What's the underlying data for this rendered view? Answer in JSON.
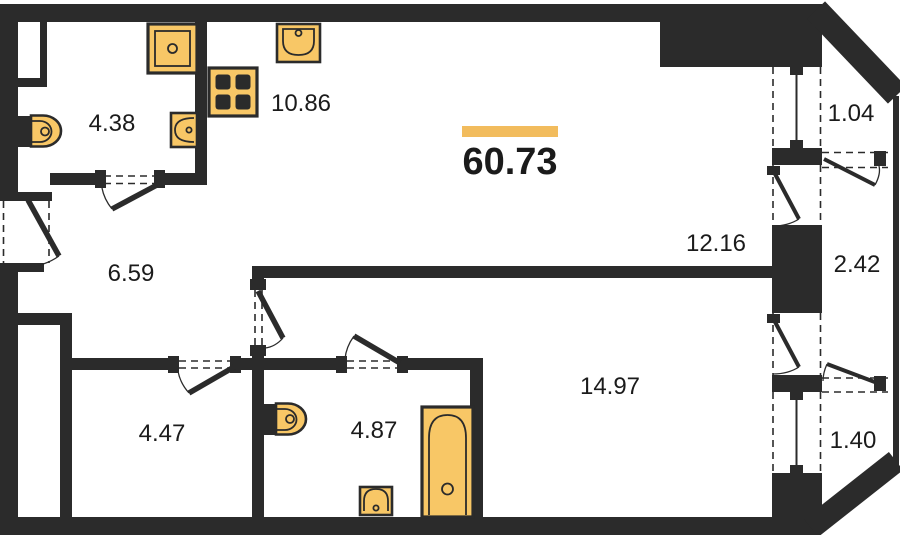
{
  "plan": {
    "total_area": {
      "label": "60.73"
    },
    "rooms": [
      {
        "name": "bathroom-top",
        "area": "4.38"
      },
      {
        "name": "kitchen",
        "area": "10.86"
      },
      {
        "name": "hallway",
        "area": "6.59"
      },
      {
        "name": "living-room",
        "area": "12.16"
      },
      {
        "name": "storage",
        "area": "4.47"
      },
      {
        "name": "bathroom-bottom",
        "area": "4.87"
      },
      {
        "name": "bedroom",
        "area": "14.97"
      }
    ],
    "balconies": [
      {
        "name": "balcony-upper",
        "area": "1.04"
      },
      {
        "name": "balcony-middle",
        "area": "2.42"
      },
      {
        "name": "balcony-lower",
        "area": "1.40"
      }
    ],
    "fixtures": [
      "shower-tray",
      "toilet",
      "washbasin",
      "kitchen-sink",
      "stove",
      "toilet",
      "washbasin",
      "bathtub"
    ],
    "colors": {
      "wall": "#2b2b2b",
      "fixture": "#F8C766",
      "accent": "#F2BC5D",
      "text": "#1b1b1b",
      "bg": "#ffffff"
    }
  }
}
